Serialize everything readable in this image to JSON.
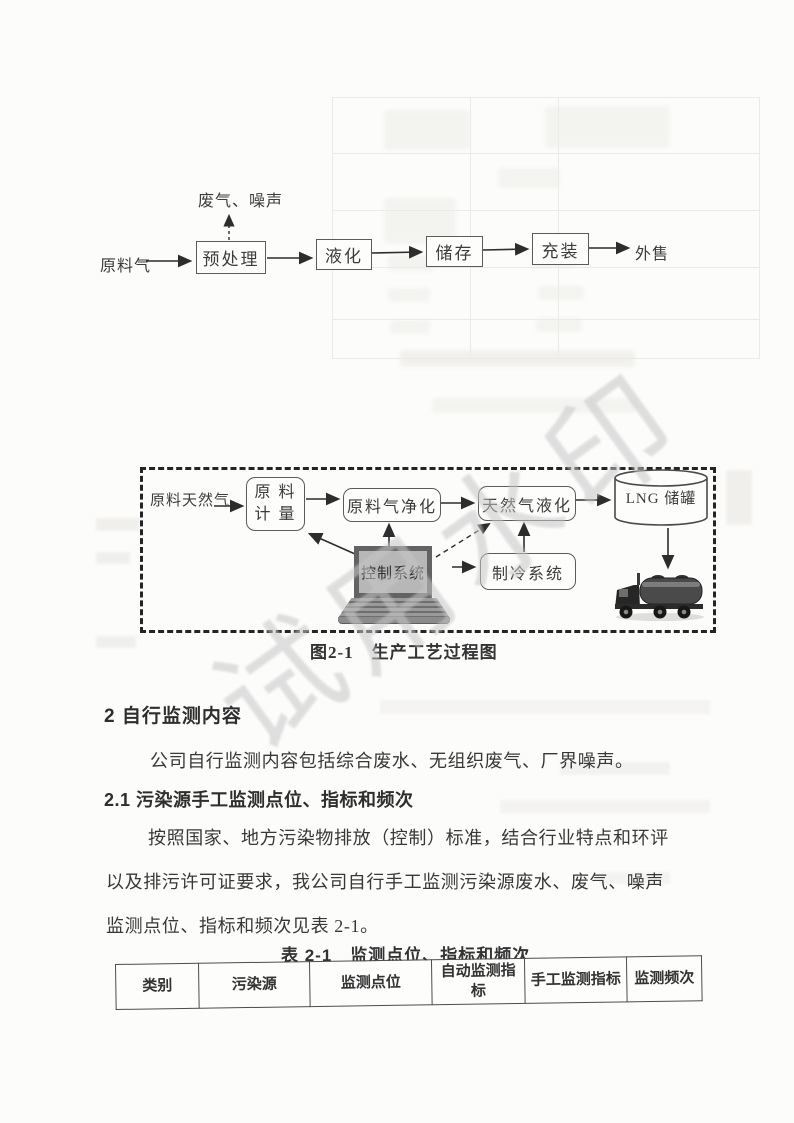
{
  "watermark": "试用水印",
  "flowchart1": {
    "source_label": "原料气",
    "emissions_label": "废气、噪声",
    "steps": [
      "预处理",
      "液化",
      "储存",
      "充装"
    ],
    "output_label": "外售"
  },
  "process_diagram": {
    "feed_label": "原料天然气",
    "metering_line1": "原 料",
    "metering_line2": "计 量",
    "purification_label": "原料气净化",
    "liquefaction_label": "天然气液化",
    "tank_label": "LNG 储罐",
    "control_label": "控制系统",
    "refrigeration_label": "制冷系统",
    "caption": "图2-1　生产工艺过程图"
  },
  "sections": {
    "heading2": "2 自行监测内容",
    "para1": "公司自行监测内容包括综合废水、无组织废气、厂界噪声。",
    "heading21": "2.1 污染源手工监测点位、指标和频次",
    "para2_lines": [
      "按照国家、地方污染物排放（控制）标准，结合行业特点和环评",
      "以及排污许可证要求，我公司自行手工监测污染源废水、废气、噪声",
      "监测点位、指标和频次见表 2-1。"
    ]
  },
  "table": {
    "caption": "表 2-1　监测点位、指标和频次",
    "headers": [
      "类别",
      "污染源",
      "监测点位",
      "自动监测指标",
      "手工监测指标",
      "监测频次"
    ]
  },
  "colors": {
    "ink": "#3a3a3a",
    "watermark_gray": "#c7c7c7"
  }
}
